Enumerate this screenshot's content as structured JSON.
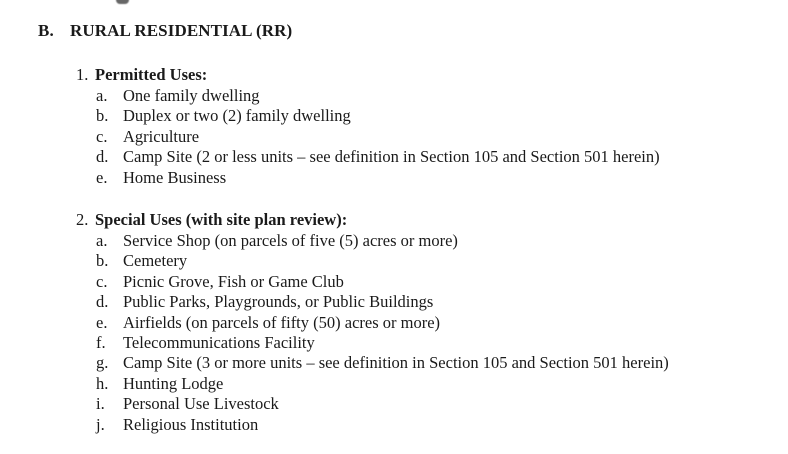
{
  "document": {
    "heading": {
      "label": "B.",
      "title": "RURAL RESIDENTIAL (RR)"
    },
    "subsections": [
      {
        "number": "1.",
        "title": "Permitted Uses:",
        "items": [
          {
            "letter": "a.",
            "text": "One family dwelling"
          },
          {
            "letter": "b.",
            "text": "Duplex or two (2) family dwelling"
          },
          {
            "letter": "c.",
            "text": "Agriculture"
          },
          {
            "letter": "d.",
            "text": "Camp Site (2 or less units – see definition in Section 105 and Section 501 herein)"
          },
          {
            "letter": "e.",
            "text": "Home Business"
          }
        ]
      },
      {
        "number": "2.",
        "title": "Special Uses (with site plan review):",
        "items": [
          {
            "letter": "a.",
            "text": "Service Shop (on parcels of five (5) acres or more)"
          },
          {
            "letter": "b.",
            "text": "Cemetery"
          },
          {
            "letter": "c.",
            "text": "Picnic Grove, Fish or Game Club"
          },
          {
            "letter": "d.",
            "text": "Public Parks, Playgrounds, or Public Buildings"
          },
          {
            "letter": "e.",
            "text": "Airfields (on parcels of fifty (50) acres or more)"
          },
          {
            "letter": "f.",
            "text": "Telecommunications Facility"
          },
          {
            "letter": "g.",
            "text": "Camp Site (3 or more units – see definition in Section 105 and Section 501 herein)"
          },
          {
            "letter": "h.",
            "text": "Hunting Lodge"
          },
          {
            "letter": "i.",
            "text": "Personal Use Livestock"
          },
          {
            "letter": "j.",
            "text": "Religious Institution"
          }
        ]
      }
    ]
  },
  "colors": {
    "background": "#ffffff",
    "text": "#1a1a1a"
  }
}
